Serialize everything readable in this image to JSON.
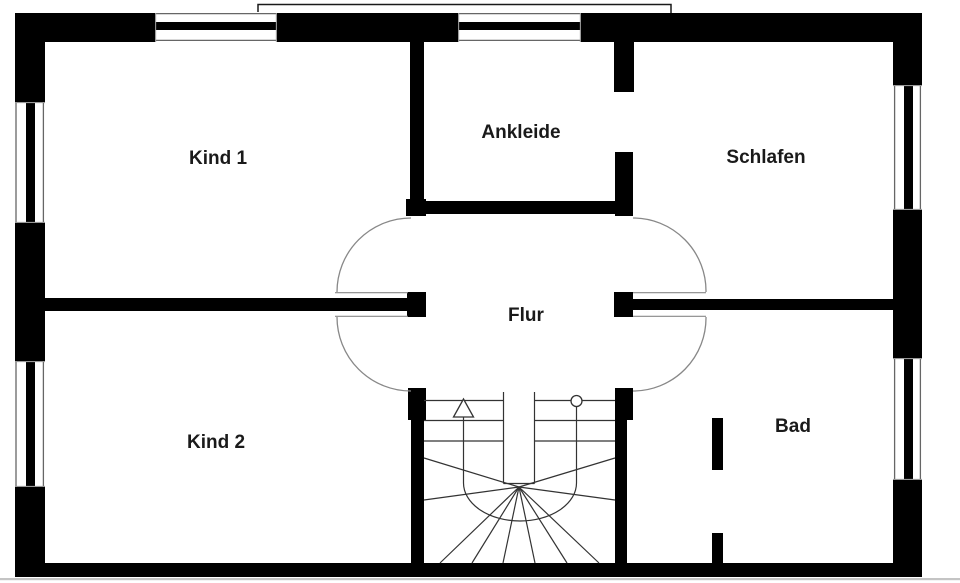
{
  "title": "Obergeschoss Grundriss",
  "rooms": [
    {
      "id": "kind1",
      "label": "Kind 1"
    },
    {
      "id": "ankleide",
      "label": "Ankleide"
    },
    {
      "id": "schlafen",
      "label": "Schlafen"
    },
    {
      "id": "flur",
      "label": "Flur"
    },
    {
      "id": "kind2",
      "label": "Kind 2"
    },
    {
      "id": "bad",
      "label": "Bad"
    }
  ],
  "symbols": {
    "stair_direction_arrow": "up",
    "stair_walkline_start": "circle"
  },
  "colors": {
    "wall": "#000000",
    "background": "#ffffff",
    "stair_line": "#333333",
    "door_arc": "#888888",
    "label_text": "#1a1a1a",
    "shadow_line": "#c4c4c4"
  }
}
